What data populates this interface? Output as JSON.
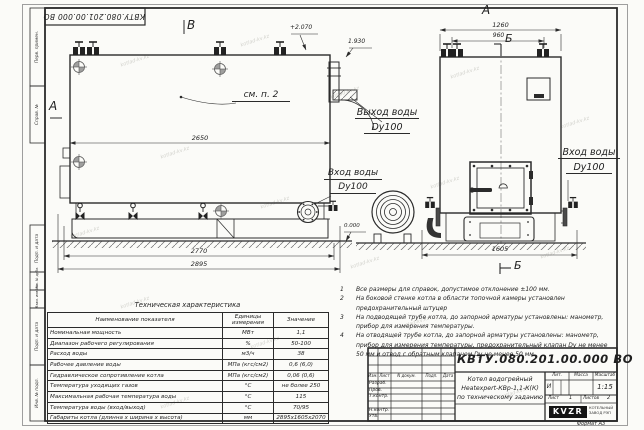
{
  "sheet": {
    "stamp_top": "КВТУ.080.201.00.000 ВО",
    "watermark": "kotlad-kv.kz",
    "margins": {
      "perv_primen": "Перв. примен.",
      "sprav_no": "Справ. №",
      "podp_data_1": "Подп. и дата",
      "inv_dubl": "Инв. № дубл.",
      "vzam_inv": "Взам. инв. №",
      "podp_data_2": "Подп. и дата",
      "inv_podl": "Инв. № подл."
    }
  },
  "drawing": {
    "side_view": {
      "view_label": "В",
      "direction_label": "А",
      "note_ref": "см. п. 2",
      "level_top": "+2.070",
      "level_outlet": "1.930",
      "level_zero": "0.000",
      "dim_2650": "2650",
      "dim_2770": "2770",
      "dim_2895": "2895",
      "outlet_line1": "Выход воды",
      "outlet_line2": "Dy100",
      "inlet_line1": "Вход воды",
      "inlet_line2": "Dy100"
    },
    "front_view": {
      "view_label": "А",
      "section_label_top": "Б",
      "section_label_bottom": "Б",
      "dim_1260": "1260",
      "dim_960": "960",
      "dim_1605": "1605",
      "inlet_line1": "Вход воды",
      "inlet_line2": "Dy100"
    }
  },
  "notes": {
    "items": [
      {
        "num": "1",
        "text": "Все размеры для справок, допустимое отклонение ±100 мм."
      },
      {
        "num": "2",
        "text": "На боковой стенке котла в области топочной камеры установлен предохранительный штуцер"
      },
      {
        "num": "3",
        "text": "На подводящей трубе котла, до запорной арматуры установлены: манометр, прибор для измерения температуры."
      },
      {
        "num": "4",
        "text": "На отводящей трубе котла, до запорной арматуры установлены: манометр, прибор для измерения температуры, предохранительный клапан Dу не менее 50 мм и отвод с обратным клапаном Dу не менее 50 мм."
      }
    ]
  },
  "tech_table": {
    "title": "Техническая характеристика",
    "headers": [
      "Наименование показателя",
      "Единицы измерения",
      "Значение"
    ],
    "rows": [
      [
        "Номинальная мощность",
        "МВт",
        "1,1"
      ],
      [
        "Диапазон рабочего регулирования",
        "%",
        "50-100"
      ],
      [
        "Расход воды",
        "м3/ч",
        "38"
      ],
      [
        "Рабочее давление воды",
        "МПа (кгс/см2)",
        "0,6 (6,0)"
      ],
      [
        "Гидравлическое сопротивление котла",
        "МПа (кгс/см2)",
        "0,06 (0,6)"
      ],
      [
        "Температура уходящих газов",
        "°С",
        "не более 250"
      ],
      [
        "Максимальная рабочая температура воды",
        "°С",
        "115"
      ],
      [
        "Температура воды (вход/выход)",
        "°С",
        "70/95"
      ],
      [
        "Габариты котла (длинна х ширина х высота)",
        "мм",
        "2895х1605х2070"
      ]
    ]
  },
  "title_block": {
    "doc_number": "КВТУ.080.201.00.000 ВО",
    "header_cols": [
      "Изм.",
      "Лист",
      "N докум.",
      "Подп.",
      "Дата"
    ],
    "sig_rows": [
      "Разраб.",
      "Пров.",
      "Т.контр.",
      "Н.контр.",
      "Утв."
    ],
    "description_lines": [
      "Котел водогрейный",
      "Heatexpert-КВр-1,1-К(К)",
      "по техническому заданию"
    ],
    "lit_label": "Лит.",
    "mass_label": "Масса",
    "scale_label": "Масштаб",
    "lit_value": "И",
    "scale_value": "1:15",
    "sheet_label": "Лист",
    "sheet_value": "1",
    "sheets_label": "Листов",
    "sheets_value": "2",
    "logo": "KVZR",
    "company_line1": "КОТЕЛЬНЫЙ",
    "company_line2": "ЗАВОД РЭП",
    "format_label": "Формат А3"
  }
}
